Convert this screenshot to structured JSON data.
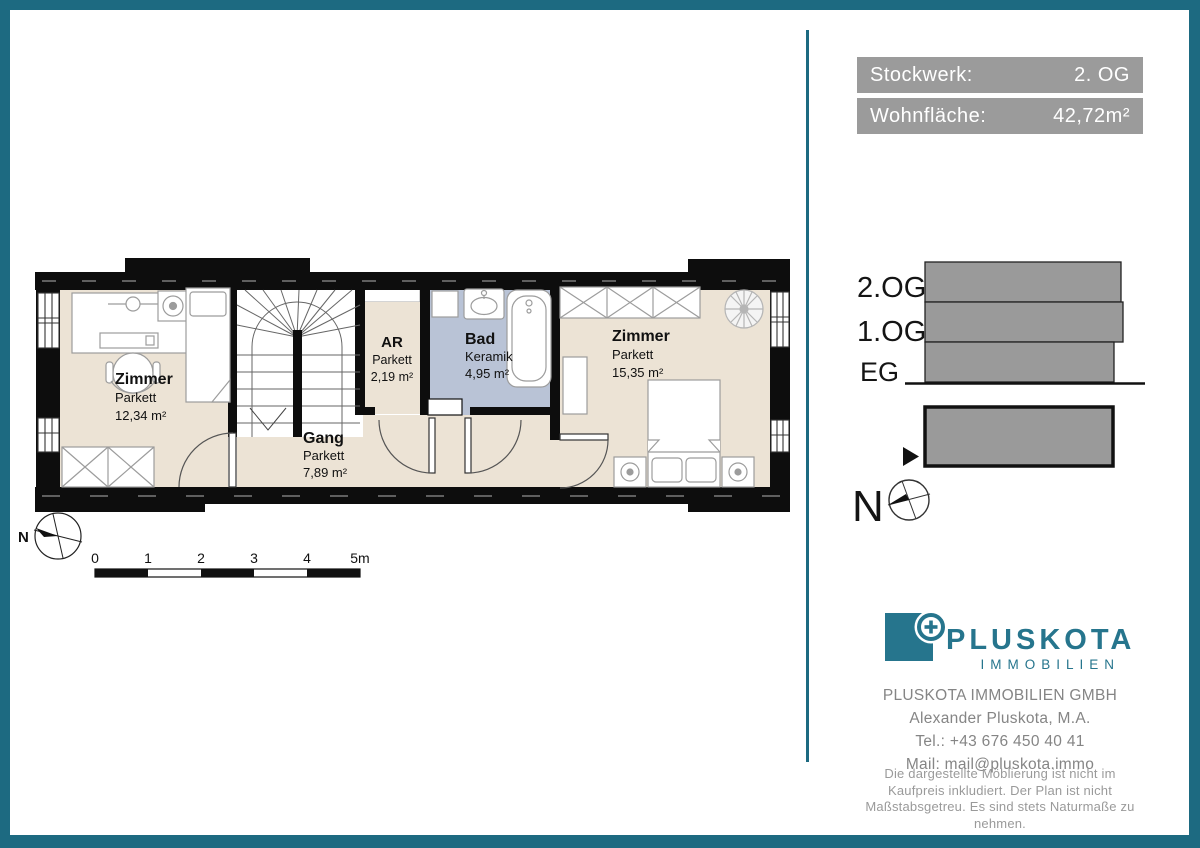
{
  "colors": {
    "accent_teal": "#1d6a81",
    "logo_teal": "#26758d",
    "bar_gray": "#9b9b9b",
    "diagram_gray": "#9a9a9a",
    "floor_parkett": "#ece3d5",
    "floor_keramik": "#b9c3d6",
    "wall_black": "#0d0d0d"
  },
  "info_panel": {
    "bars": [
      {
        "label": "Stockwerk:",
        "value": "2. OG"
      },
      {
        "label": "Wohnfläche:",
        "value": "42,72m²"
      }
    ]
  },
  "floorplan": {
    "rooms": [
      {
        "name": "Zimmer",
        "floor": "Parkett",
        "area": "12,34 m²"
      },
      {
        "name": "Gang",
        "floor": "Parkett",
        "area": "7,89 m²"
      },
      {
        "name": "AR",
        "floor": "Parkett",
        "area": "2,19 m²"
      },
      {
        "name": "Bad",
        "floor": "Keramik",
        "area": "4,95 m²"
      },
      {
        "name": "Zimmer",
        "floor": "Parkett",
        "area": "15,35 m²"
      }
    ],
    "north_label": "N",
    "scale_ticks": [
      "0",
      "1",
      "2",
      "3",
      "4",
      "5m"
    ]
  },
  "section_diagram": {
    "floors": [
      "2.OG",
      "1.OG",
      "EG"
    ],
    "north_label": "N"
  },
  "logo": {
    "brand": "PLUSKOTA",
    "subtitle": "IMMOBILIEN"
  },
  "contact": {
    "company": "PLUSKOTA IMMOBILIEN GMBH",
    "person": "Alexander Pluskota, M.A.",
    "phone": "Tel.: +43 676 450 40 41",
    "email": "Mail: mail@pluskota.immo"
  },
  "disclaimer": "Die dargestellte Möblierung ist nicht im Kaufpreis inkludiert. Der Plan ist nicht Maßstabsgetreu. Es sind stets Naturmaße zu nehmen."
}
